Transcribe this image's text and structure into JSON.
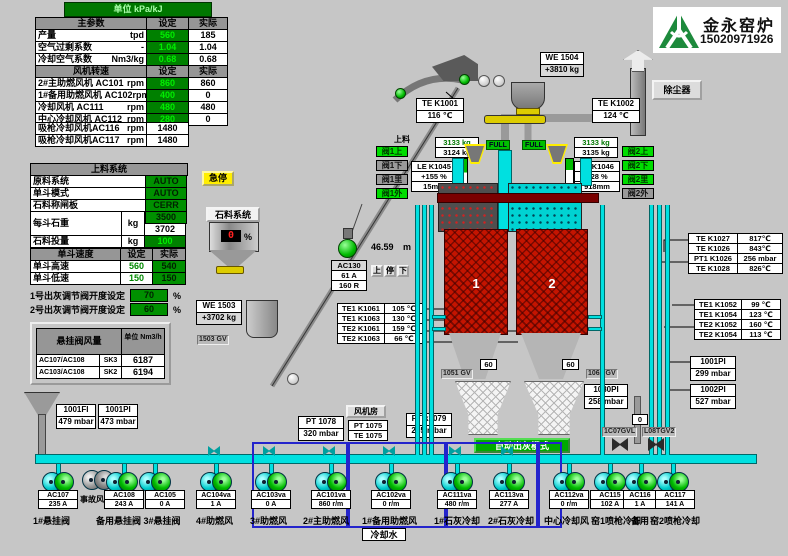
{
  "unit_bar": {
    "label": "单位 kPa/kJ"
  },
  "logo": {
    "company": "金永窑炉",
    "phone": "15020971926"
  },
  "main_table": {
    "header": {
      "name": "主参数",
      "set": "设定",
      "actual": "实际"
    },
    "rows": [
      {
        "label": "产量",
        "unit": "tpd",
        "set": "560",
        "actual": "185"
      },
      {
        "label": "空气过剩系数",
        "unit": "-",
        "set": "1.04",
        "actual": "1.04"
      },
      {
        "label": "冷却空气系数",
        "unit": "Nm3/kg",
        "set": "0.68",
        "actual": "0.68"
      }
    ],
    "fan_header": {
      "name": "风机转速",
      "set": "设定",
      "actual": "实际"
    },
    "fan_rows": [
      {
        "label": "2#主助燃风机 AC101",
        "unit": "rpm",
        "set": "860",
        "actual": "860"
      },
      {
        "label": "1#备用助燃风机 AC102",
        "unit": "rpm",
        "set": "400",
        "actual": "0"
      },
      {
        "label": "冷却风机 AC111",
        "unit": "rpm",
        "set": "480",
        "actual": "480"
      },
      {
        "label": "中心冷却风机 AC112",
        "unit": "rpm",
        "set": "280",
        "actual": "0"
      }
    ],
    "extra_rows": [
      {
        "label": "吸枪冷却风机AC116",
        "unit": "rpm",
        "value": "1480"
      },
      {
        "label": "吸枪冷却风机AC117",
        "unit": "rpm",
        "value": "1480"
      }
    ]
  },
  "feed_table": {
    "title": "上料系统",
    "rows": [
      {
        "label": "原料系统",
        "value": "AUTO"
      },
      {
        "label": "单斗模式",
        "value": "AUTO"
      },
      {
        "label": "石料称闸板",
        "value": "CERR"
      }
    ],
    "weight_row": {
      "label": "每斗石重",
      "unit": "kg",
      "set": "3500",
      "actual": "3702"
    },
    "charge_row": {
      "label": "石料投量",
      "unit": "kg",
      "value": "100"
    },
    "speed": {
      "title": "单斗速度",
      "set_h": "设定",
      "act_h": "实际",
      "rows": [
        {
          "label": "单斗高速",
          "set": "560",
          "actual": "540"
        },
        {
          "label": "单斗低速",
          "set": "150",
          "actual": "150"
        }
      ]
    }
  },
  "ash_setpoints": [
    {
      "label": "1号出灰调节阀开度设定",
      "value": "70",
      "unit": "%"
    },
    {
      "label": "2号出灰调节阀开度设定",
      "value": "60",
      "unit": "%"
    }
  ],
  "flow_table": {
    "title": "悬挂阀风量",
    "unit_header": "单位 Nm3/h",
    "rows": [
      {
        "label": "AC107/AC108",
        "tag": "SK3",
        "value": "6187"
      },
      {
        "label": "AC103/AC108",
        "tag": "SK2",
        "value": "6194"
      }
    ]
  },
  "top": {
    "we1504": {
      "label": "WE 1504",
      "value": "+3810  kg"
    },
    "te_k1001": {
      "label": "TE K1001",
      "value": "116 ℃"
    },
    "te_k1002": {
      "label": "TE K1002",
      "value": "124 ℃"
    },
    "dust_collector": "除尘器",
    "estop": "急停",
    "feed_label": "上料"
  },
  "stone": {
    "title": "石料系统",
    "pct": "0",
    "pct_unit": "%",
    "we1503": "WE 1503",
    "we1503_v": "+3702  kg",
    "gv": "1503 GV"
  },
  "skip": {
    "height": "46.59",
    "unit": "m",
    "ac": "AC130",
    "amp": "61 A",
    "r": "160 R",
    "btn_up": "上",
    "btn_stop": "停",
    "btn_down": "下"
  },
  "hopper_left": {
    "w_set": "3133 kg",
    "w_act": "3124 kg",
    "le": "LE K1045",
    "pct": "+155  %",
    "mm": "15mm",
    "full": "FULL"
  },
  "hopper_right": {
    "w_set": "3133 kg",
    "w_act": "3135 kg",
    "le": "LE K1046",
    "pct": "+28  %",
    "mm": "918mm",
    "full": "FULL"
  },
  "valves_left": [
    {
      "label": "阀1上",
      "on": true
    },
    {
      "label": "阀1下",
      "on": false
    },
    {
      "label": "阀1里",
      "on": false
    },
    {
      "label": "阀1外",
      "on": true
    }
  ],
  "valves_right": [
    {
      "label": "阀2上",
      "on": true
    },
    {
      "label": "阀2下",
      "on": true
    },
    {
      "label": "阀2里",
      "on": true
    },
    {
      "label": "阀2外",
      "on": false
    }
  ],
  "kilns": {
    "k1": "1",
    "k2": "2"
  },
  "temps_left": [
    {
      "label": "TE1 K1061",
      "value": "105 ℃"
    },
    {
      "label": "TE1 K1063",
      "value": "130 ℃"
    },
    {
      "label": "TE2 K1061",
      "value": "159 ℃"
    },
    {
      "label": "TE2 K1063",
      "value": "66 ℃"
    }
  ],
  "temps_right_top": [
    {
      "label": "TE K1027",
      "value": "817℃"
    },
    {
      "label": "TE K1026",
      "value": "843℃"
    },
    {
      "label": "PT1 K1026",
      "value": "256 mbar"
    },
    {
      "label": "TE K1028",
      "value": "826℃"
    }
  ],
  "temps_right_mid": [
    {
      "label": "TE1 K1052",
      "value": "99 ℃"
    },
    {
      "label": "TE1 K1054",
      "value": "123 ℃"
    },
    {
      "label": "TE2 K1052",
      "value": "160 ℃"
    },
    {
      "label": "TE2 K1054",
      "value": "113 ℃"
    }
  ],
  "pi_right": [
    {
      "label": "1001PI",
      "value": "299 mbar"
    },
    {
      "label": "1002PI",
      "value": "527 mbar"
    }
  ],
  "discharge": {
    "left_pct": "60",
    "right_pct": "60",
    "gv1": "1051 GV",
    "gv2": "1062 GV",
    "pi": "1080PI",
    "pi_v": "258 mbar",
    "auto_btn": "自动出灰模式",
    "pt1079": "PT k1079",
    "pt1079_v": "265 mbar"
  },
  "fan_room": {
    "title": "风机房",
    "pt1078": "PT 1078",
    "pt1078_v": "320 mbar",
    "pt1075": "PT 1075",
    "te1075": "TE 1075"
  },
  "left_pi": [
    {
      "label": "1001FI",
      "value": "479 mbar"
    },
    {
      "label": "1001PI",
      "value": "473 mbar"
    }
  ],
  "pumps": [
    {
      "tag": "AC107",
      "value": "235  A"
    },
    {
      "tag": "AC108",
      "value": "243  A"
    },
    {
      "tag": "AC105",
      "value": "0  A"
    },
    {
      "tag": "AC104va",
      "value": "1  A"
    },
    {
      "tag": "AC103va",
      "value": "0  A"
    },
    {
      "tag": "AC101va",
      "value": "860 r/m"
    },
    {
      "tag": "AC102va",
      "value": "0 r/m"
    },
    {
      "tag": "AC111va",
      "value": "480 r/m"
    },
    {
      "tag": "AC113va",
      "value": "277  A"
    },
    {
      "tag": "AC112va",
      "value": "0 r/m"
    },
    {
      "tag": "AC115",
      "value": "102  A"
    },
    {
      "tag": "AC116",
      "value": "1  A"
    },
    {
      "tag": "AC117",
      "value": "141  A"
    }
  ],
  "pump_labels": {
    "accident_fan": "事故风机",
    "g1": "1#悬挂阀",
    "g2": "备用悬挂阀 3#悬挂阀",
    "g3": "4#助燃风",
    "g4": "3#助燃风",
    "g5": "2#主助燃风",
    "g6": "1#备用助燃风",
    "g7": "1#石灰冷却",
    "g8": "2#石灰冷却",
    "g9": "中心冷却风",
    "g10": "窑1喷枪冷却",
    "g11": "备用",
    "g12": "窑2喷枪冷却",
    "cooling_water": "冷却水"
  },
  "right_valves": {
    "v0": "0",
    "v1": "1C07GVL",
    "v2": "L08TGV2"
  }
}
